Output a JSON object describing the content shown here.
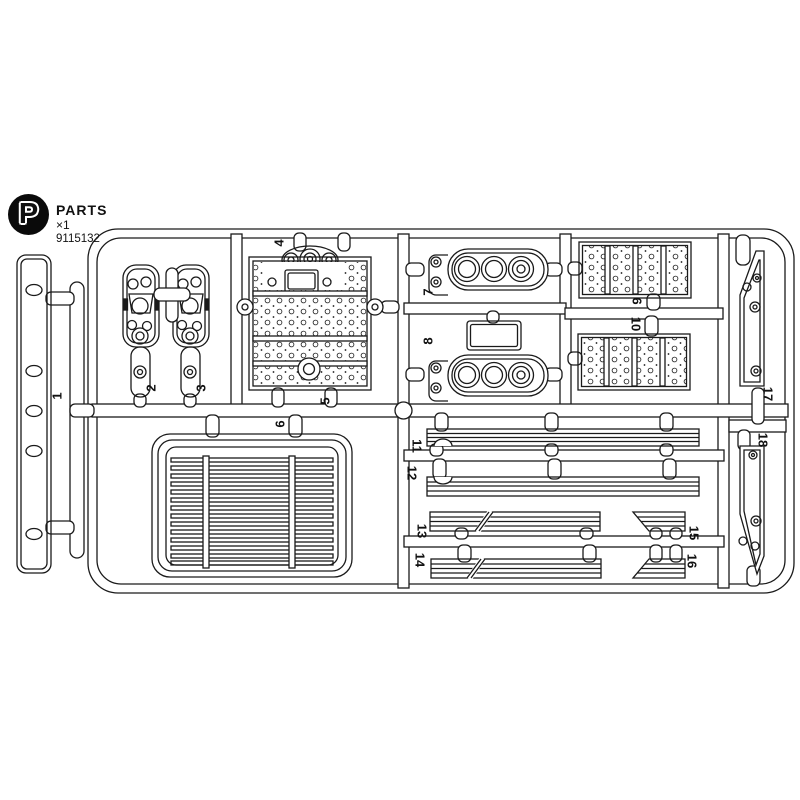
{
  "header": {
    "letter": "P",
    "title": "PARTS",
    "quantity": "×1",
    "item_code": "9115132"
  },
  "sprue": {
    "parts": [
      {
        "number": "1"
      },
      {
        "number": "2"
      },
      {
        "number": "3"
      },
      {
        "number": "4"
      },
      {
        "number": "5"
      },
      {
        "number": "6"
      },
      {
        "number": "7"
      },
      {
        "number": "8"
      },
      {
        "number": "9"
      },
      {
        "number": "10"
      },
      {
        "number": "11"
      },
      {
        "number": "12"
      },
      {
        "number": "13"
      },
      {
        "number": "14"
      },
      {
        "number": "15"
      },
      {
        "number": "16"
      },
      {
        "number": "17"
      },
      {
        "number": "18"
      }
    ]
  },
  "colors": {
    "line": "#1a1a1a",
    "background": "#ffffff",
    "logo": "#0a0a0a"
  }
}
